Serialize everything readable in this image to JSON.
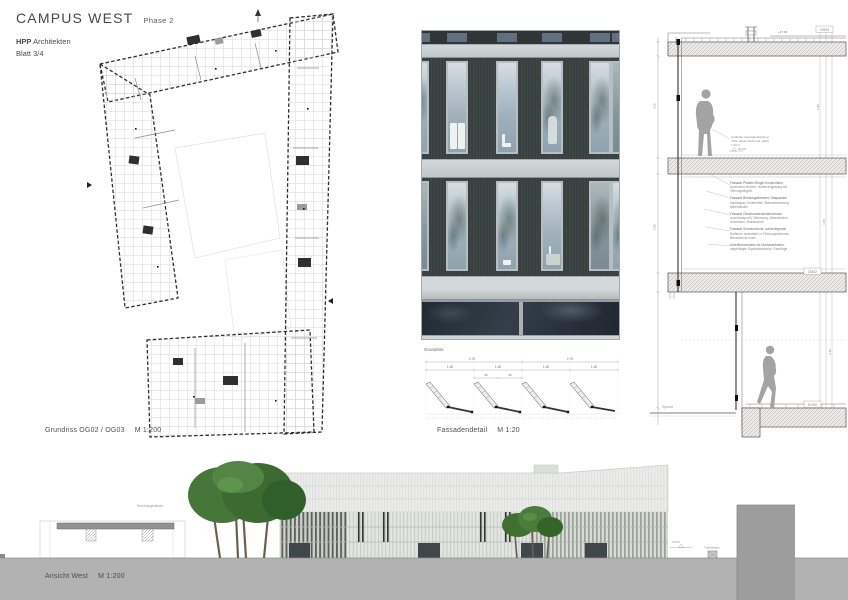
{
  "header": {
    "title": "CAMPUS WEST",
    "phase": "Phase 2",
    "firm_name": "HPP",
    "firm_suffix": "Architekten",
    "sheet": "Blatt 3/4"
  },
  "captions": {
    "plan": "Grundriss OG02 / OG03",
    "plan_scale": "M 1:200",
    "facade": "Fassadendetail",
    "facade_scale": "M 1:20",
    "elevation": "Ansicht West",
    "elevation_scale": "M 1:200"
  },
  "facade_plan": {
    "label": "Grundriss",
    "dim_total_1": "2.70",
    "dim_total_2": "2.70",
    "dim_unit": "1.35",
    "dim_sub_1": "35",
    "dim_sub_2": "35"
  },
  "section": {
    "floor_tags": {
      "top": "OG03",
      "mid": "OG02",
      "bottom": "EG00"
    },
    "top_level": "+17.96",
    "dims": {
      "left_upper": "3.35",
      "left_lower": "2.80",
      "right_upper": "2.80",
      "right_mid": "3.35",
      "right_lower": "4.45"
    },
    "annotations": [
      "Fassade Pfosten-Riegel-Konstruktion, Aluminium eloxiert, Isolierverglasung mit Öffnungsflügeln",
      "Fassade Brüstungselement: Glaspaneel dunkelgrau, hinterlüftet, Wärmedämmung Mineralwolle",
      "Fassade Geschossdeckenanschluss: Anschlussprofil, Dämmung, Abdeckblech Aluminium, Brandschott",
      "Fassade Sonnenschutz: außenliegende Raffstore windstabil, in Führungsschienen, Blendschutz innen",
      "Unterflurkonvektor im Hohlraumboden, abgehängte Gipskartondecke, Randfuge"
    ],
    "note": "Geländer Ganzglasbrüstung VSG, absturzsichernd, Höhe 1.00 m",
    "level_mark": "±0.00",
    "ground_label": "Spinde"
  },
  "elevation": {
    "pavilion_label": "Seminargebäude",
    "trafo_label": "Trafostation",
    "level_mark": "±0.00"
  },
  "colors": {
    "facade_panel_dark": "#394040",
    "facade_glass": "#a9b8c3",
    "slab_band": "#c9cdd0",
    "ground_band": "#b2b2b2",
    "tree_green": "#47763a",
    "silhouette_gray": "#a3a3a3"
  }
}
